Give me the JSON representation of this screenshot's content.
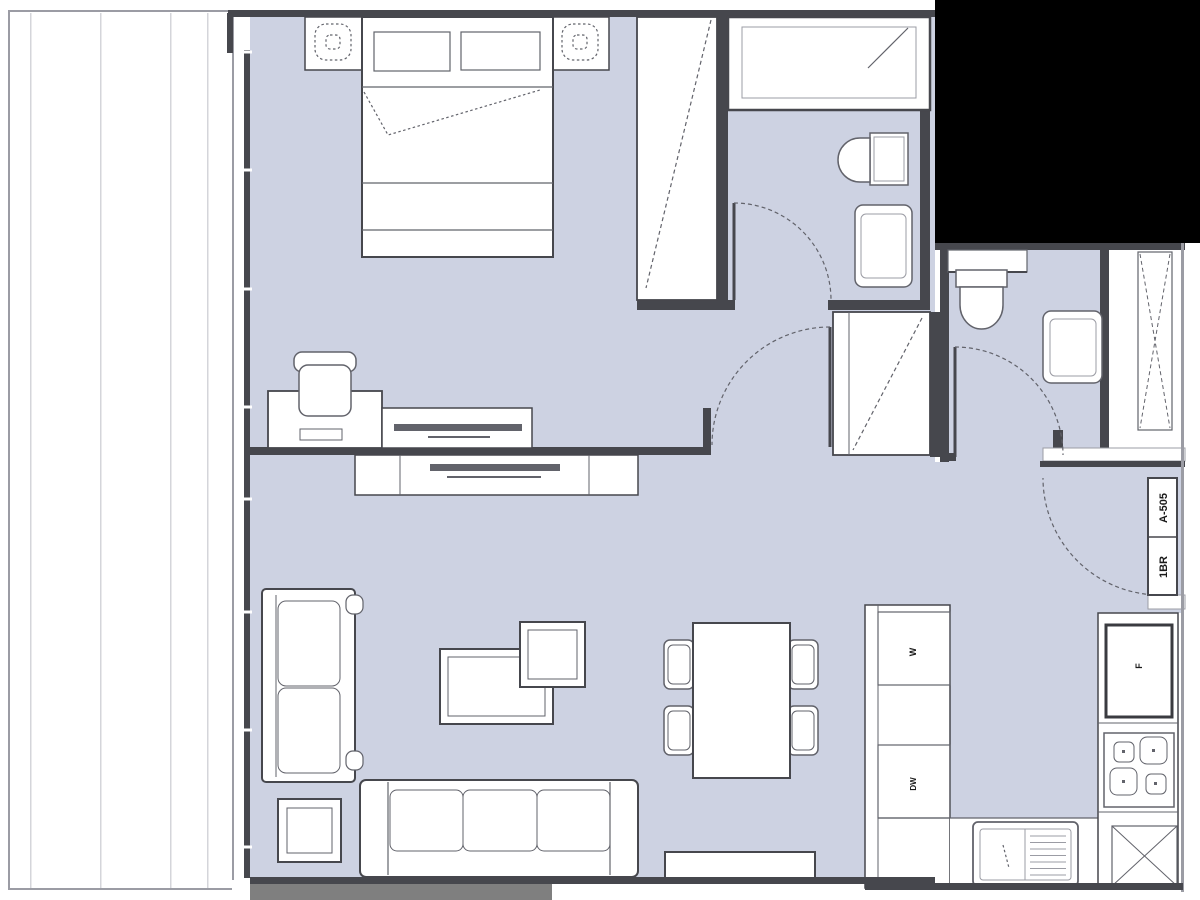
{
  "unit_door": {
    "number": "A-505",
    "type": "1BR"
  },
  "appliances": {
    "washer": "W",
    "dishwasher": "DW",
    "refrigerator": "F"
  },
  "colors": {
    "background": "#ffffff",
    "floor": "#cdd2e2",
    "wall": "#46474d",
    "furniture": "#62636b",
    "light_line": "#9b9ca4",
    "balcony_line": "#d4d5da",
    "parapet": "#7f7f7f",
    "masked": "#000000",
    "label_text": "#1a1a1a"
  }
}
